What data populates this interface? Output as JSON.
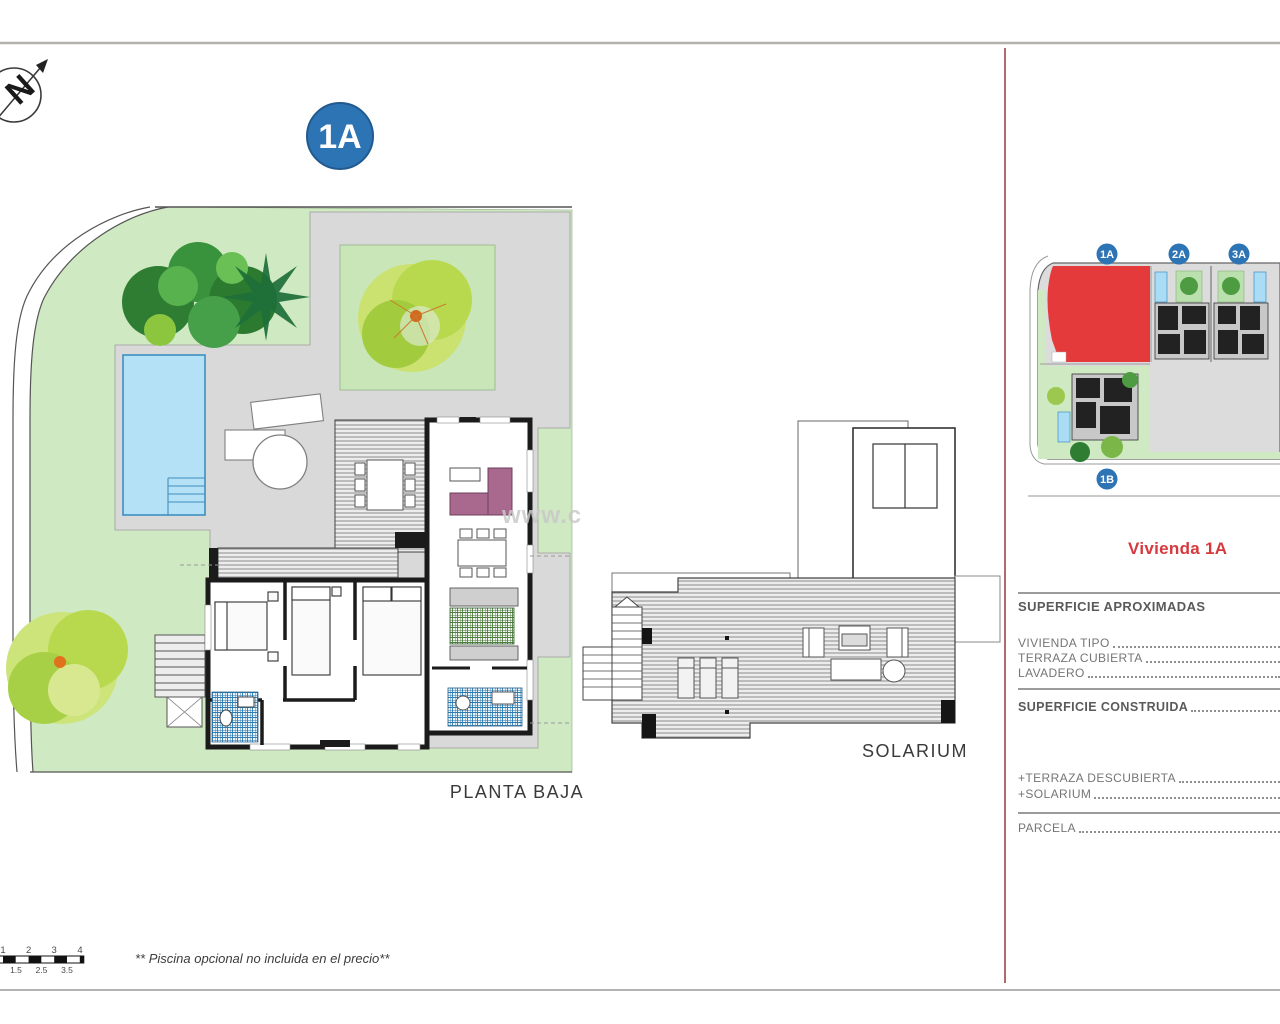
{
  "page": {
    "main_badge": "1A",
    "floor_label": "PLANTA BAJA",
    "solarium_label": "SOLARIUM",
    "footnote": "** Piscina opcional no incluida en el precio**",
    "watermark": "www.c",
    "compass_letter": "N"
  },
  "scale_bar": {
    "top_labels": [
      "1",
      "2",
      "3",
      "4"
    ],
    "bottom_labels": [
      "1.5",
      "2.5",
      "3.5"
    ]
  },
  "site_inset": {
    "badges": {
      "a1": "1A",
      "a2": "2A",
      "a3": "3A",
      "b1": "1B"
    },
    "highlighted_plot": "1A"
  },
  "panel": {
    "title": "Vivienda 1A",
    "approx_heading": "SUPERFICIE APROXIMADAS",
    "rows": [
      {
        "label": "VIVIENDA TIPO"
      },
      {
        "label": "TERRAZA CUBIERTA"
      },
      {
        "label": "LAVADERO"
      }
    ],
    "construida_heading": "SUPERFICIE CONSTRUIDA",
    "extra_rows": [
      {
        "label": "+TERRAZA DESCUBIERTA"
      },
      {
        "label": "+SOLARIUM"
      }
    ],
    "parcela_row": {
      "label": "PARCELA"
    }
  },
  "colors": {
    "badge_blue": "#2d74b5",
    "plot_red": "#e53a3c",
    "title_red": "#d6393d",
    "divider_red": "#b06a6a",
    "garden_green": "#cfe9c2",
    "paving_gray": "#d9d9d9",
    "pool_blue": "#b5e1f6",
    "sofa_mauve": "#a9688e"
  }
}
